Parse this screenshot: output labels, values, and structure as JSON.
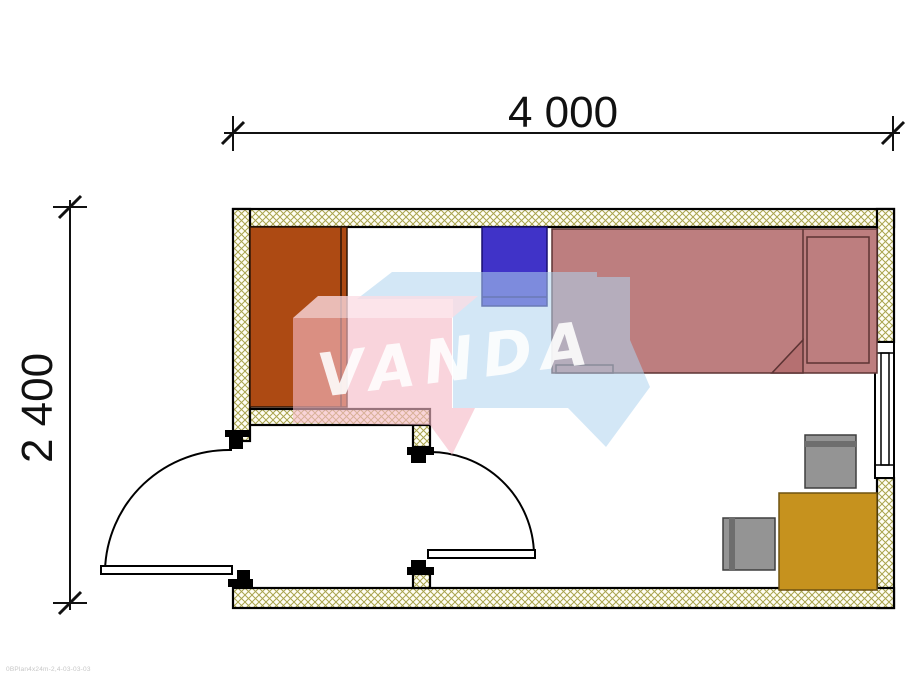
{
  "page": {
    "type": "floor-plan-drawing",
    "background": "#ffffff"
  },
  "dimensions": {
    "width_label": "4 000",
    "height_label": "2 400"
  },
  "watermark": {
    "text": "VANDA",
    "text_color": "#ffffff",
    "pink_block_color": "#f5b9c6",
    "blue_block_color": "#aed3ee"
  },
  "plan": {
    "wall_hatch_color": "#a9a44e",
    "wall_outline_color": "#000000",
    "furniture": [
      {
        "name": "wardrobe",
        "color": "#ad4a13"
      },
      {
        "name": "blue-cabinet",
        "color": "#4033c8"
      },
      {
        "name": "bed",
        "color": "#bd7e7f"
      },
      {
        "name": "desk",
        "color": "#c6921e"
      },
      {
        "name": "chair-top",
        "color": "#949494"
      },
      {
        "name": "chair-left",
        "color": "#949494"
      }
    ],
    "openings": [
      {
        "name": "entry-door",
        "swing": "outward-left"
      },
      {
        "name": "interior-door",
        "swing": "inward-right"
      },
      {
        "name": "window",
        "wall": "right"
      }
    ]
  },
  "footer": {
    "note": "0BPlan4x24m-2,4-03-03-03"
  }
}
